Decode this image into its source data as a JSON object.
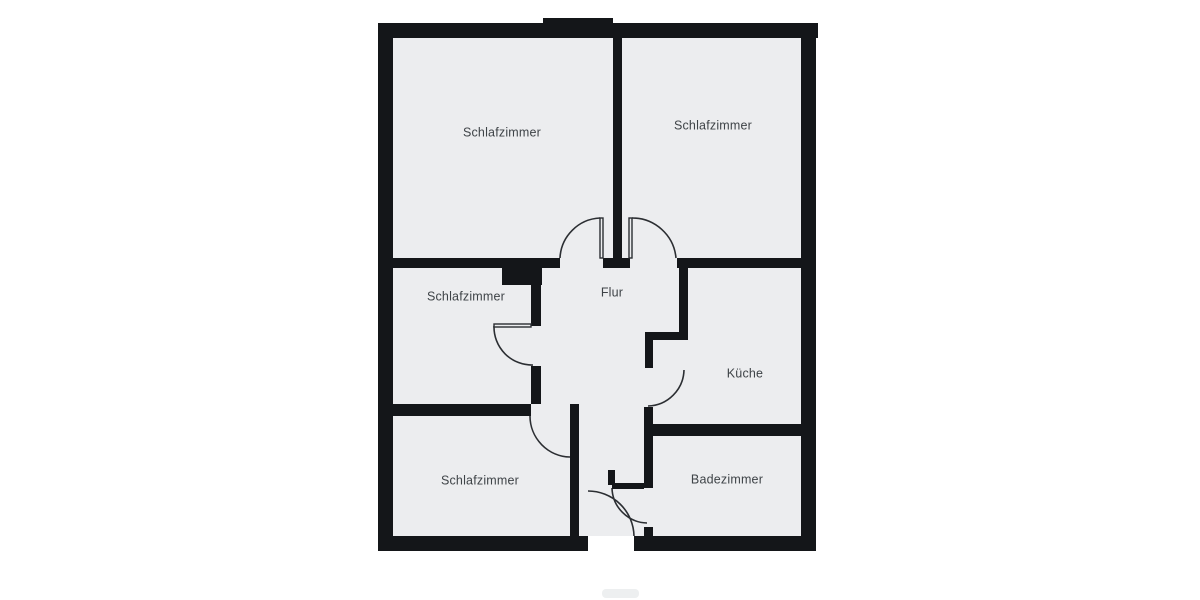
{
  "title": "Grundriss Wohnung (Floor plan)",
  "colors": {
    "background": "#ffffff",
    "room_fill": "#ecedef",
    "wall": "#141619",
    "door_stroke": "#2b2e32",
    "label": "#3e4347",
    "watermark": "#dfe1e3"
  },
  "floorplan": {
    "interior": {
      "x": 393,
      "y": 37,
      "w": 408,
      "h": 499
    },
    "outer_walls": [
      {
        "name": "outer-wall-top",
        "x": 378,
        "y": 23,
        "w": 440,
        "h": 15
      },
      {
        "name": "outer-wall-top-bump",
        "x": 543,
        "y": 18,
        "w": 70,
        "h": 7
      },
      {
        "name": "outer-wall-left",
        "x": 378,
        "y": 23,
        "w": 15,
        "h": 528
      },
      {
        "name": "outer-wall-right",
        "x": 801,
        "y": 23,
        "w": 15,
        "h": 528
      },
      {
        "name": "outer-wall-bottom-left",
        "x": 378,
        "y": 536,
        "w": 210,
        "h": 15
      },
      {
        "name": "outer-wall-bottom-right",
        "x": 634,
        "y": 536,
        "w": 182,
        "h": 15
      }
    ],
    "inner_walls": [
      {
        "name": "wall-divider-top-bedrooms",
        "x": 613,
        "y": 37,
        "w": 9,
        "h": 221
      },
      {
        "name": "wall-band-top-left",
        "x": 393,
        "y": 258,
        "w": 167,
        "h": 10
      },
      {
        "name": "wall-band-top-center-stub",
        "x": 603,
        "y": 258,
        "w": 27,
        "h": 10
      },
      {
        "name": "wall-band-top-right",
        "x": 677,
        "y": 258,
        "w": 124,
        "h": 10
      },
      {
        "name": "wall-notch-block",
        "x": 502,
        "y": 258,
        "w": 40,
        "h": 27
      },
      {
        "name": "wall-flur-left-upper",
        "x": 531,
        "y": 285,
        "w": 10,
        "h": 41
      },
      {
        "name": "wall-flur-left-lower",
        "x": 531,
        "y": 366,
        "w": 10,
        "h": 38
      },
      {
        "name": "wall-band-middle",
        "x": 393,
        "y": 404,
        "w": 138,
        "h": 12
      },
      {
        "name": "wall-vestibule",
        "x": 570,
        "y": 404,
        "w": 9,
        "h": 132
      },
      {
        "name": "wall-kueche-upper",
        "x": 679,
        "y": 268,
        "w": 9,
        "h": 64
      },
      {
        "name": "wall-kueche-jog",
        "x": 645,
        "y": 332,
        "w": 43,
        "h": 8
      },
      {
        "name": "wall-kueche-doorjamb",
        "x": 645,
        "y": 340,
        "w": 8,
        "h": 28
      },
      {
        "name": "wall-kueche-lower",
        "x": 644,
        "y": 407,
        "w": 9,
        "h": 81
      },
      {
        "name": "wall-bad-divider",
        "x": 644,
        "y": 424,
        "w": 157,
        "h": 12
      },
      {
        "name": "wall-bad-stub",
        "x": 644,
        "y": 527,
        "w": 9,
        "h": 9
      },
      {
        "name": "wall-partition-thin",
        "x": 612,
        "y": 483,
        "w": 32,
        "h": 6
      },
      {
        "name": "wall-pillar-stub",
        "x": 608,
        "y": 470,
        "w": 7,
        "h": 15
      }
    ],
    "door_leaves": [
      {
        "name": "door-leaf-schlafzimmer-top-left",
        "x": 600,
        "y": 218,
        "w": 3,
        "h": 40
      },
      {
        "name": "door-leaf-schlafzimmer-top-right",
        "x": 629,
        "y": 218,
        "w": 3,
        "h": 40
      },
      {
        "name": "door-leaf-schlafzimmer-middle",
        "x": 494,
        "y": 324,
        "w": 37,
        "h": 3
      }
    ],
    "door_arcs": [
      {
        "name": "door-arc-schlafzimmer-top-left",
        "d": "M 560 258 A 42 42 0 0 1 600 218"
      },
      {
        "name": "door-arc-schlafzimmer-top-right",
        "d": "M 632 218 A 44 44 0 0 1 676 258"
      },
      {
        "name": "door-arc-schlafzimmer-middle",
        "d": "M 494 326 A 38 38 0 0 0 533 365"
      },
      {
        "name": "door-arc-schlafzimmer-bottom",
        "d": "M 530 416 A 41 41 0 0 0 570 457"
      },
      {
        "name": "door-arc-kueche",
        "d": "M 684 370 A 37 37 0 0 1 648 406"
      },
      {
        "name": "door-arc-badezimmer",
        "d": "M 612 488 A 36 36 0 0 0 647 523"
      },
      {
        "name": "door-arc-entrance",
        "d": "M 588 491 A 46 46 0 0 1 634 536"
      }
    ],
    "rooms": [
      {
        "name": "room-label-schlafzimmer-top-left",
        "label": "Schlafzimmer",
        "cx": 502,
        "cy": 133
      },
      {
        "name": "room-label-schlafzimmer-top-right",
        "label": "Schlafzimmer",
        "cx": 713,
        "cy": 126
      },
      {
        "name": "room-label-schlafzimmer-middle",
        "label": "Schlafzimmer",
        "cx": 466,
        "cy": 297
      },
      {
        "name": "room-label-flur",
        "label": "Flur",
        "cx": 612,
        "cy": 293
      },
      {
        "name": "room-label-kueche",
        "label": "Küche",
        "cx": 745,
        "cy": 374
      },
      {
        "name": "room-label-schlafzimmer-bottom",
        "label": "Schlafzimmer",
        "cx": 480,
        "cy": 481
      },
      {
        "name": "room-label-badezimmer",
        "label": "Badezimmer",
        "cx": 727,
        "cy": 480
      }
    ],
    "label_font_size": 12.5
  },
  "watermark": {
    "x": 602,
    "y": 589,
    "w": 37,
    "h": 9
  }
}
